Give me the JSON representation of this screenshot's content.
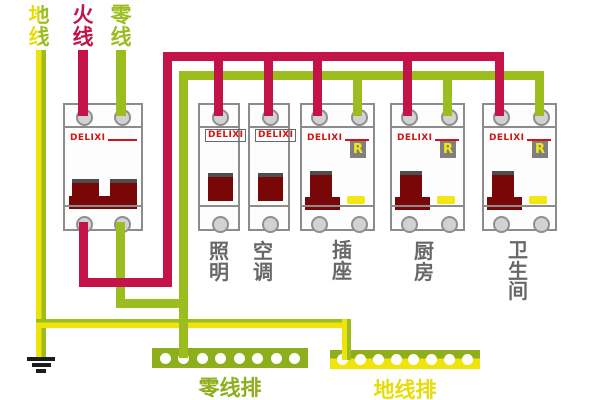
{
  "supply": {
    "ground_label": "地线",
    "live_label": "火线",
    "neutral_label": "零线"
  },
  "breakers": [
    {
      "name": "main",
      "brand": "DELIXI",
      "label": ""
    },
    {
      "name": "lighting",
      "brand": "DELIXI",
      "label": "照明"
    },
    {
      "name": "air-conditioner",
      "brand": "DELIXI",
      "label": "空调"
    },
    {
      "name": "socket",
      "brand": "DELIXI",
      "label": "插座",
      "rcd_badge": "R"
    },
    {
      "name": "kitchen",
      "brand": "DELIXI",
      "label": "厨房",
      "rcd_badge": "R"
    },
    {
      "name": "bathroom",
      "brand": "DELIXI",
      "label": "卫生间",
      "rcd_badge": "R"
    }
  ],
  "bus_bars": {
    "neutral": {
      "label": "零线排",
      "holes": 8
    },
    "ground": {
      "label": "地线排",
      "holes": 8
    }
  },
  "colors": {
    "live_red": "#c31349",
    "neutral_green": "#9cbd1f",
    "ground_yellow": "#eee40c",
    "ground_stripe_green": "#9cbd1f",
    "handle_maroon": "#7a0708",
    "brand_red": "#cf1414",
    "neutral_bus_green": "#8fae1c",
    "ground_bus_label_yellow": "#e6dc0a",
    "circuit_label_gray": "#686868",
    "rcd_badge_bg": "#7f7f7f",
    "rcd_badge_text": "#f5e812"
  }
}
